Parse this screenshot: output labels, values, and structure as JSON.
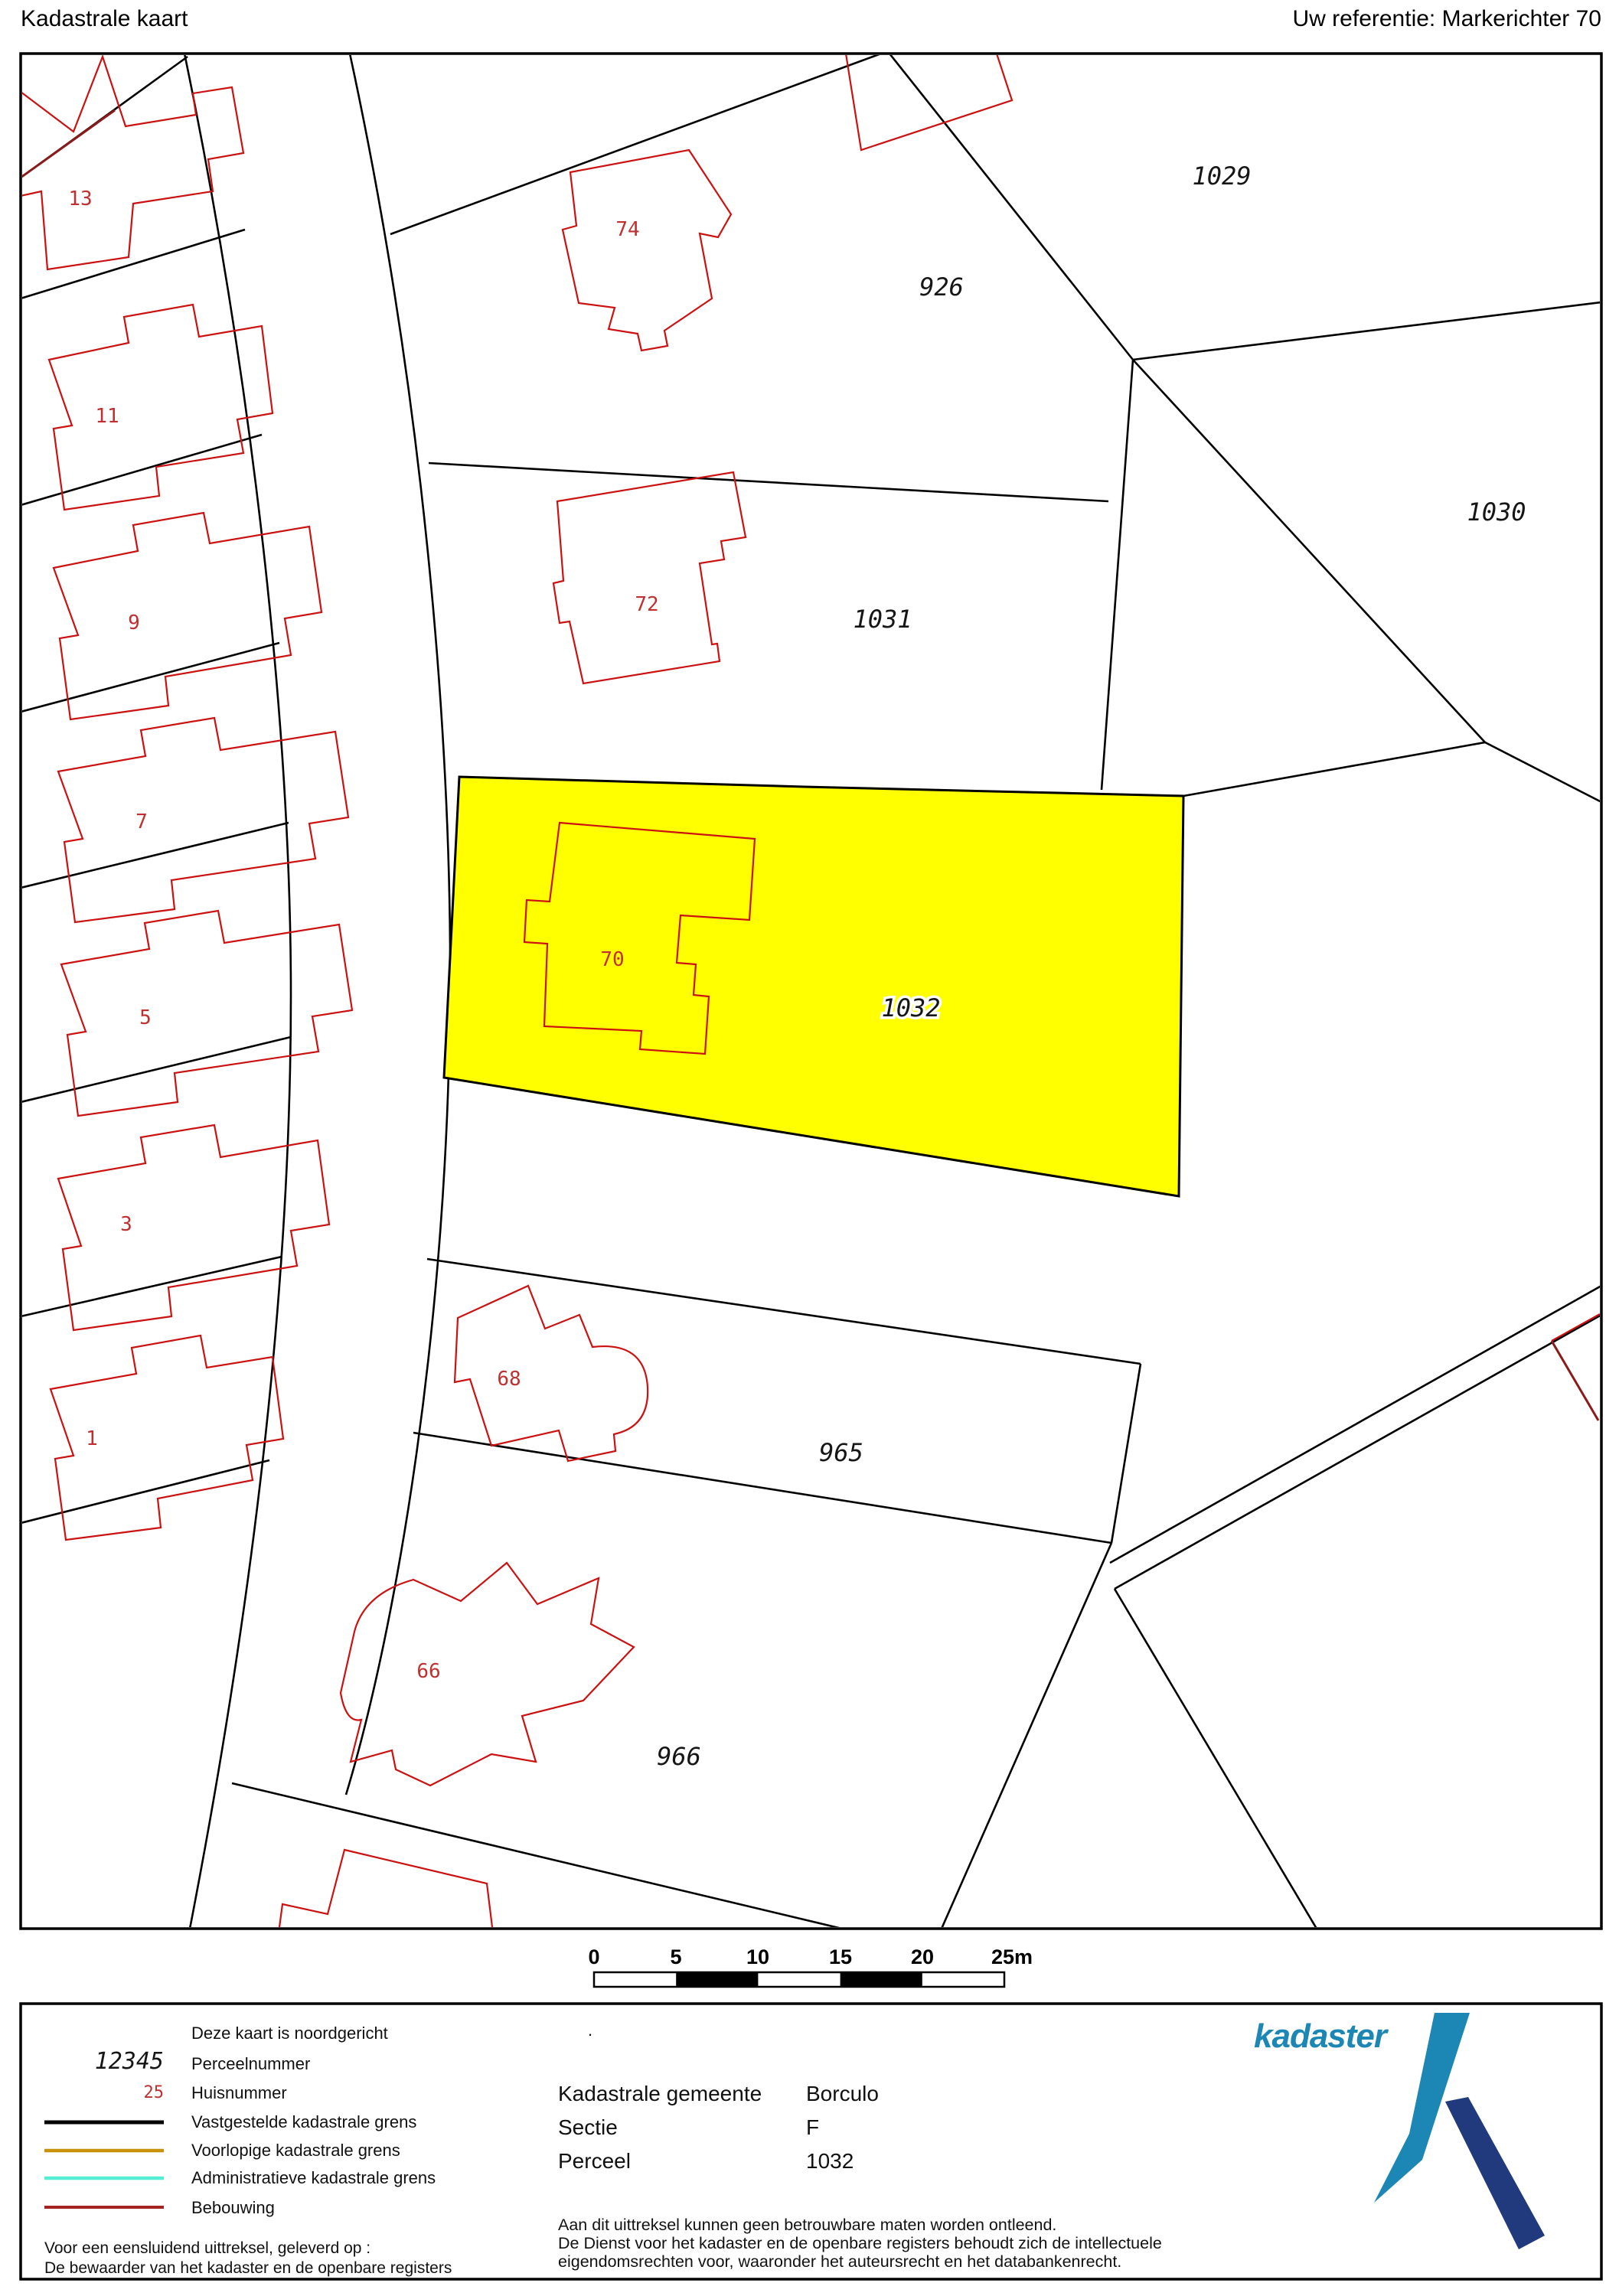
{
  "header": {
    "title": "Kadastrale kaart",
    "reference": "Uw referentie: Markerichter 70"
  },
  "map": {
    "parcels": [
      "1029",
      "926",
      "1031",
      "1030",
      "1032",
      "965",
      "966"
    ],
    "houses": [
      "13",
      "11",
      "9",
      "7",
      "5",
      "3",
      "1",
      "74",
      "72",
      "70",
      "68",
      "66"
    ],
    "highlighted_parcel": "1032"
  },
  "scalebar": {
    "labels": [
      "0",
      "5",
      "10",
      "15",
      "20",
      "25m"
    ]
  },
  "legend": {
    "items": [
      {
        "symbol": "",
        "label": "Deze kaart is noordgericht"
      },
      {
        "symbol": "12345",
        "label": "Perceelnummer"
      },
      {
        "symbol": "25",
        "label": "Huisnummer"
      },
      {
        "symbol": "line-black",
        "label": "Vastgestelde kadastrale grens"
      },
      {
        "symbol": "line-gold",
        "label": "Voorlopige kadastrale grens"
      },
      {
        "symbol": "line-cyan",
        "label": "Administratieve kadastrale grens"
      },
      {
        "symbol": "line-red",
        "label": "Bebouwing"
      }
    ]
  },
  "footer_left": {
    "line1": "Voor een eensluidend uittreksel, geleverd op :",
    "line2": "De bewaarder van het kadaster en de openbare registers"
  },
  "details": {
    "note_dot": ".",
    "rows": [
      {
        "label": "Kadastrale gemeente",
        "value": "Borculo"
      },
      {
        "label": "Sectie",
        "value": "F"
      },
      {
        "label": "Perceel",
        "value": "1032"
      }
    ]
  },
  "disclaimer": {
    "line1": "Aan dit uittreksel kunnen geen betrouwbare maten worden ontleend.",
    "line2": "De Dienst voor het kadaster en de openbare registers behoudt zich de intellectuele",
    "line3": "eigendomsrechten voor, waaronder het auteursrecht en het databankenrecht.",
    "line4": ""
  },
  "logo": {
    "text": "kadaster"
  },
  "colors": {
    "highlight": "#FFFF00",
    "boundary": "#000000",
    "building": "#CC1111",
    "building_dark": "#8B1A1A",
    "house_number": "#C03030",
    "provisional": "#C8920A",
    "administrative": "#53EED3",
    "bebouwing_legend": "#A52222",
    "logo_light": "#1C86B5",
    "logo_dark": "#213A7D"
  }
}
